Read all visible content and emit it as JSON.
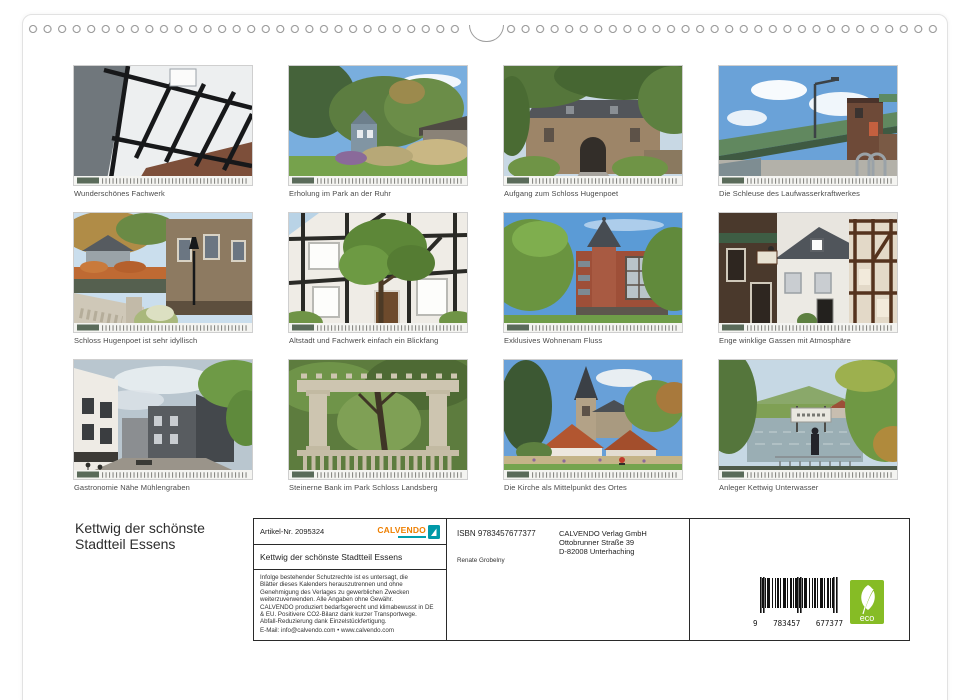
{
  "title": {
    "line1": "Kettwig der schönste",
    "line2": "Stadtteil Essens"
  },
  "gallery": {
    "items": [
      {
        "caption": "Wunderschönes Fachwerk"
      },
      {
        "caption": "Erholung im Park an der Ruhr"
      },
      {
        "caption": "Aufgang zum Schloss Hugenpoet"
      },
      {
        "caption": "Die Schleuse des Laufwasserkraftwerkes"
      },
      {
        "caption": "Schloss Hugenpoet ist sehr idyllisch"
      },
      {
        "caption": "Altstadt und Fachwerk einfach ein Blickfang"
      },
      {
        "caption": "Exklusives Wohnenam Fluss"
      },
      {
        "caption": "Enge winklige Gassen mit Atmosphäre"
      },
      {
        "caption": "Gastronomie Nähe Mühlengraben"
      },
      {
        "caption": "Steinerne Bank im Park Schloss Landsberg"
      },
      {
        "caption": "Die Kirche als Mittelpunkt des Ortes"
      },
      {
        "caption": "Anleger Kettwig Unterwasser"
      }
    ]
  },
  "imprint": {
    "artikel_nr": "Artikel-Nr. 2095324",
    "brand": "CALVENDO",
    "calendar_title": "Kettwig der schönste Stadtteil Essens",
    "legal_lines": [
      "Infolge bestehender Schutzrechte ist es untersagt, die",
      "Blätter dieses Kalenders herauszutrennen und ohne",
      "Genehmigung des Verlages zu gewerblichen Zwecken",
      "weiterzuverwenden. Alle Angaben ohne Gewähr.",
      "CALVENDO produziert bedarfsgerecht und klimabewusst in DE",
      "& EU. Positivere CO2-Bilanz dank kurzer Transportwege.",
      "Abfall-Reduzierung dank Einzelstückfertigung."
    ],
    "email_line": "E-Mail: info@calvendo.com • www.calvendo.com",
    "isbn": "ISBN 9783457677377",
    "publisher": {
      "line1": "CALVENDO Verlag GmbH",
      "line2": "Ottobrunner Straße 39",
      "line3": "D-82008 Unterhaching"
    },
    "author": "Renate Grobelny",
    "barcode": {
      "left_digit": "9",
      "group1": "783457",
      "group2": "677377"
    },
    "eco_label": "eco"
  },
  "colors": {
    "brand_orange": "#ee7f00",
    "brand_teal": "#00a0b0",
    "eco_green": "#86bc25"
  }
}
